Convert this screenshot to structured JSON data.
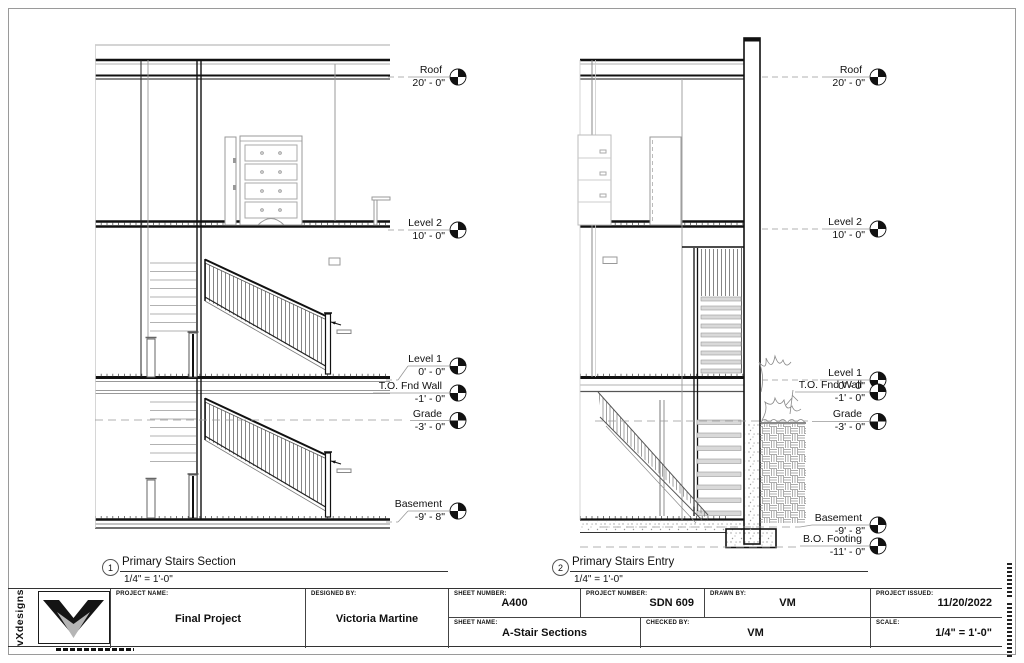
{
  "sheet": {
    "sections": [
      {
        "number": "1",
        "title": "Primary Stairs Section",
        "scale": "1/4\" = 1'-0\""
      },
      {
        "number": "2",
        "title": "Primary Stairs Entry",
        "scale": "1/4\" = 1'-0\""
      }
    ],
    "left_levels": [
      {
        "name": "Roof",
        "elev": "20' - 0\""
      },
      {
        "name": "Level 2",
        "elev": "10' - 0\""
      },
      {
        "name": "Level 1",
        "elev": "0' - 0\""
      },
      {
        "name": "T.O. Fnd Wall",
        "elev": "-1' - 0\""
      },
      {
        "name": "Grade",
        "elev": "-3' - 0\""
      },
      {
        "name": "Basement",
        "elev": "-9' - 8\""
      }
    ],
    "right_levels": [
      {
        "name": "Roof",
        "elev": "20' - 0\""
      },
      {
        "name": "Level 2",
        "elev": "10' - 0\""
      },
      {
        "name": "Level 1",
        "elev": "0' - 0\""
      },
      {
        "name": "T.O. Fnd Wall",
        "elev": "-1' - 0\""
      },
      {
        "name": "Grade",
        "elev": "-3' - 0\""
      },
      {
        "name": "Basement",
        "elev": "-9' - 8\""
      },
      {
        "name": "B.O. Footing",
        "elev": "-11' - 0\""
      }
    ]
  },
  "titleblock": {
    "brand": "vXdesigns",
    "project_name_label": "PROJECT NAME:",
    "project_name": "Final Project",
    "designed_by_label": "DESIGNED BY:",
    "designed_by": "Victoria Martine",
    "sheet_number_label": "SHEET NUMBER:",
    "sheet_number": "A400",
    "project_number_label": "PROJECT NUMBER:",
    "project_number": "SDN 609",
    "drawn_by_label": "DRAWN BY:",
    "drawn_by": "VM",
    "project_issued_label": "PROJECT ISSUED:",
    "project_issued": "11/20/2022",
    "sheet_name_label": "SHEET NAME:",
    "sheet_name": "A-Stair Sections",
    "checked_by_label": "CHECKED BY:",
    "checked_by": "VM",
    "scale_label": "SCALE:",
    "scale": "1/4\" = 1'-0\""
  },
  "colors": {
    "ink": "#111111",
    "light_line": "#999999",
    "tread_fill": "#d9d9d9"
  }
}
